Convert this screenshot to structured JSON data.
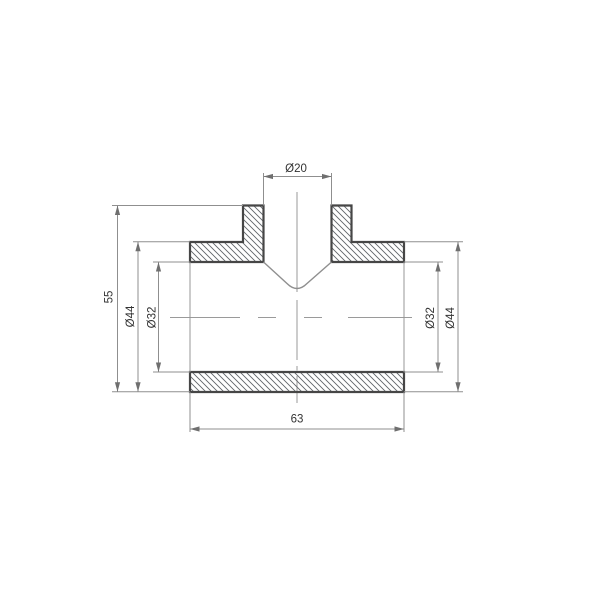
{
  "drawing": {
    "kind": "pipe-tee-fitting-section",
    "dimensions": {
      "branch_bore": {
        "label": "Ø20",
        "value": 20
      },
      "body_height": {
        "label": "55",
        "value": 55
      },
      "outer_diameter_left": {
        "label": "Ø44",
        "value": 44
      },
      "inner_diameter_left": {
        "label": "Ø32",
        "value": 32
      },
      "inner_diameter_right": {
        "label": "Ø32",
        "value": 32
      },
      "outer_diameter_right": {
        "label": "Ø44",
        "value": 44
      },
      "body_length": {
        "label": "63",
        "value": 63
      }
    },
    "colors": {
      "background": "#ffffff",
      "outline": "#464646",
      "hatch": "#5f6368",
      "thin_line": "#979797",
      "text": "#333333"
    }
  }
}
